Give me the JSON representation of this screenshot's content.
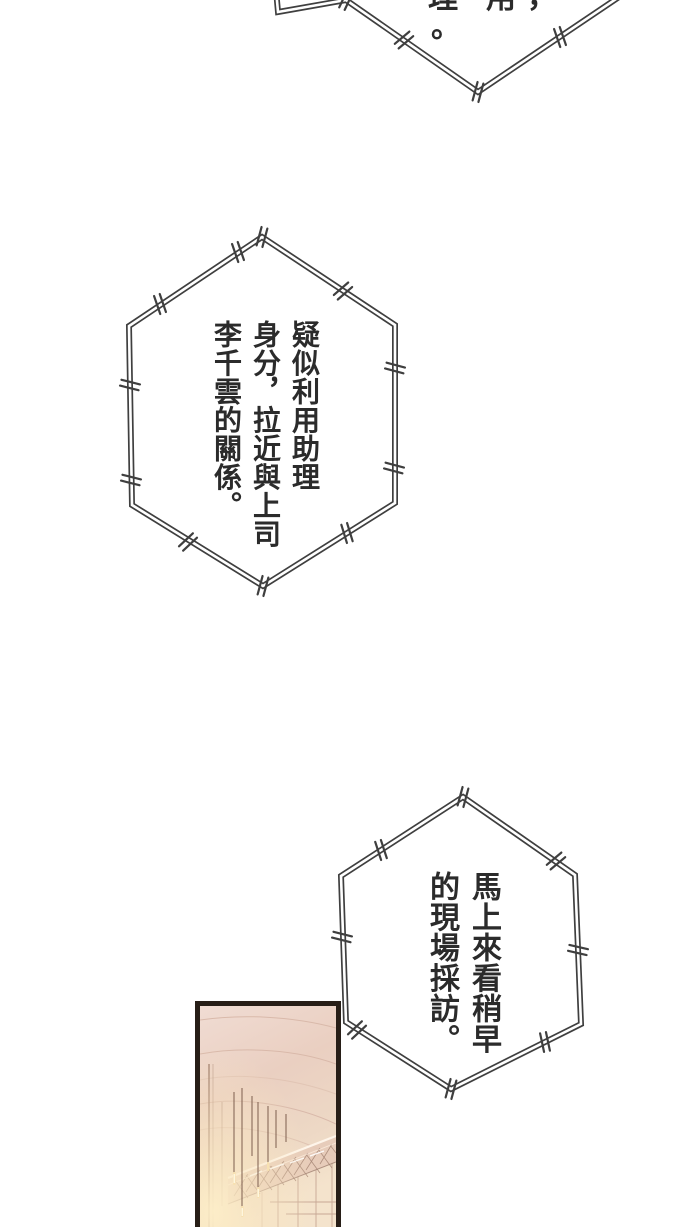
{
  "page": {
    "kind": "webtoon comic page",
    "background_color": "#ffffff"
  },
  "speech_bubbles": {
    "top_partial": {
      "description": "hexagonal bubble cut off by top edge of page",
      "visible_glyphs": [
        "理",
        "用",
        "，",
        "。"
      ]
    },
    "middle": {
      "text": "疑似利用助理身分，拉近與上司李千雲的關係。",
      "columns_right_to_left": [
        "疑似利用助理",
        "身分，拉近與上司",
        "李千雲的關係。"
      ]
    },
    "bottom": {
      "text": "馬上來看稍早的現場採訪。",
      "columns_right_to_left": [
        "馬上來看稍早",
        "的現場採訪。"
      ]
    }
  },
  "panel": {
    "description": "warm-lit interior: curved ceiling, hanging pendant lights, lattice light truss, panelled wall, bright glow at lower left",
    "colors": {
      "border": "#271e17",
      "ceiling": "#eacfc1",
      "wall": "#edd8c5",
      "glow": "#fdeec8",
      "truss_line": "#a98878",
      "cord": "#7d5e4e"
    }
  },
  "style": {
    "bubble_border_color": "#3f3f3f",
    "bubble_fill": "#ffffff",
    "text_color": "#2b2b2b"
  }
}
